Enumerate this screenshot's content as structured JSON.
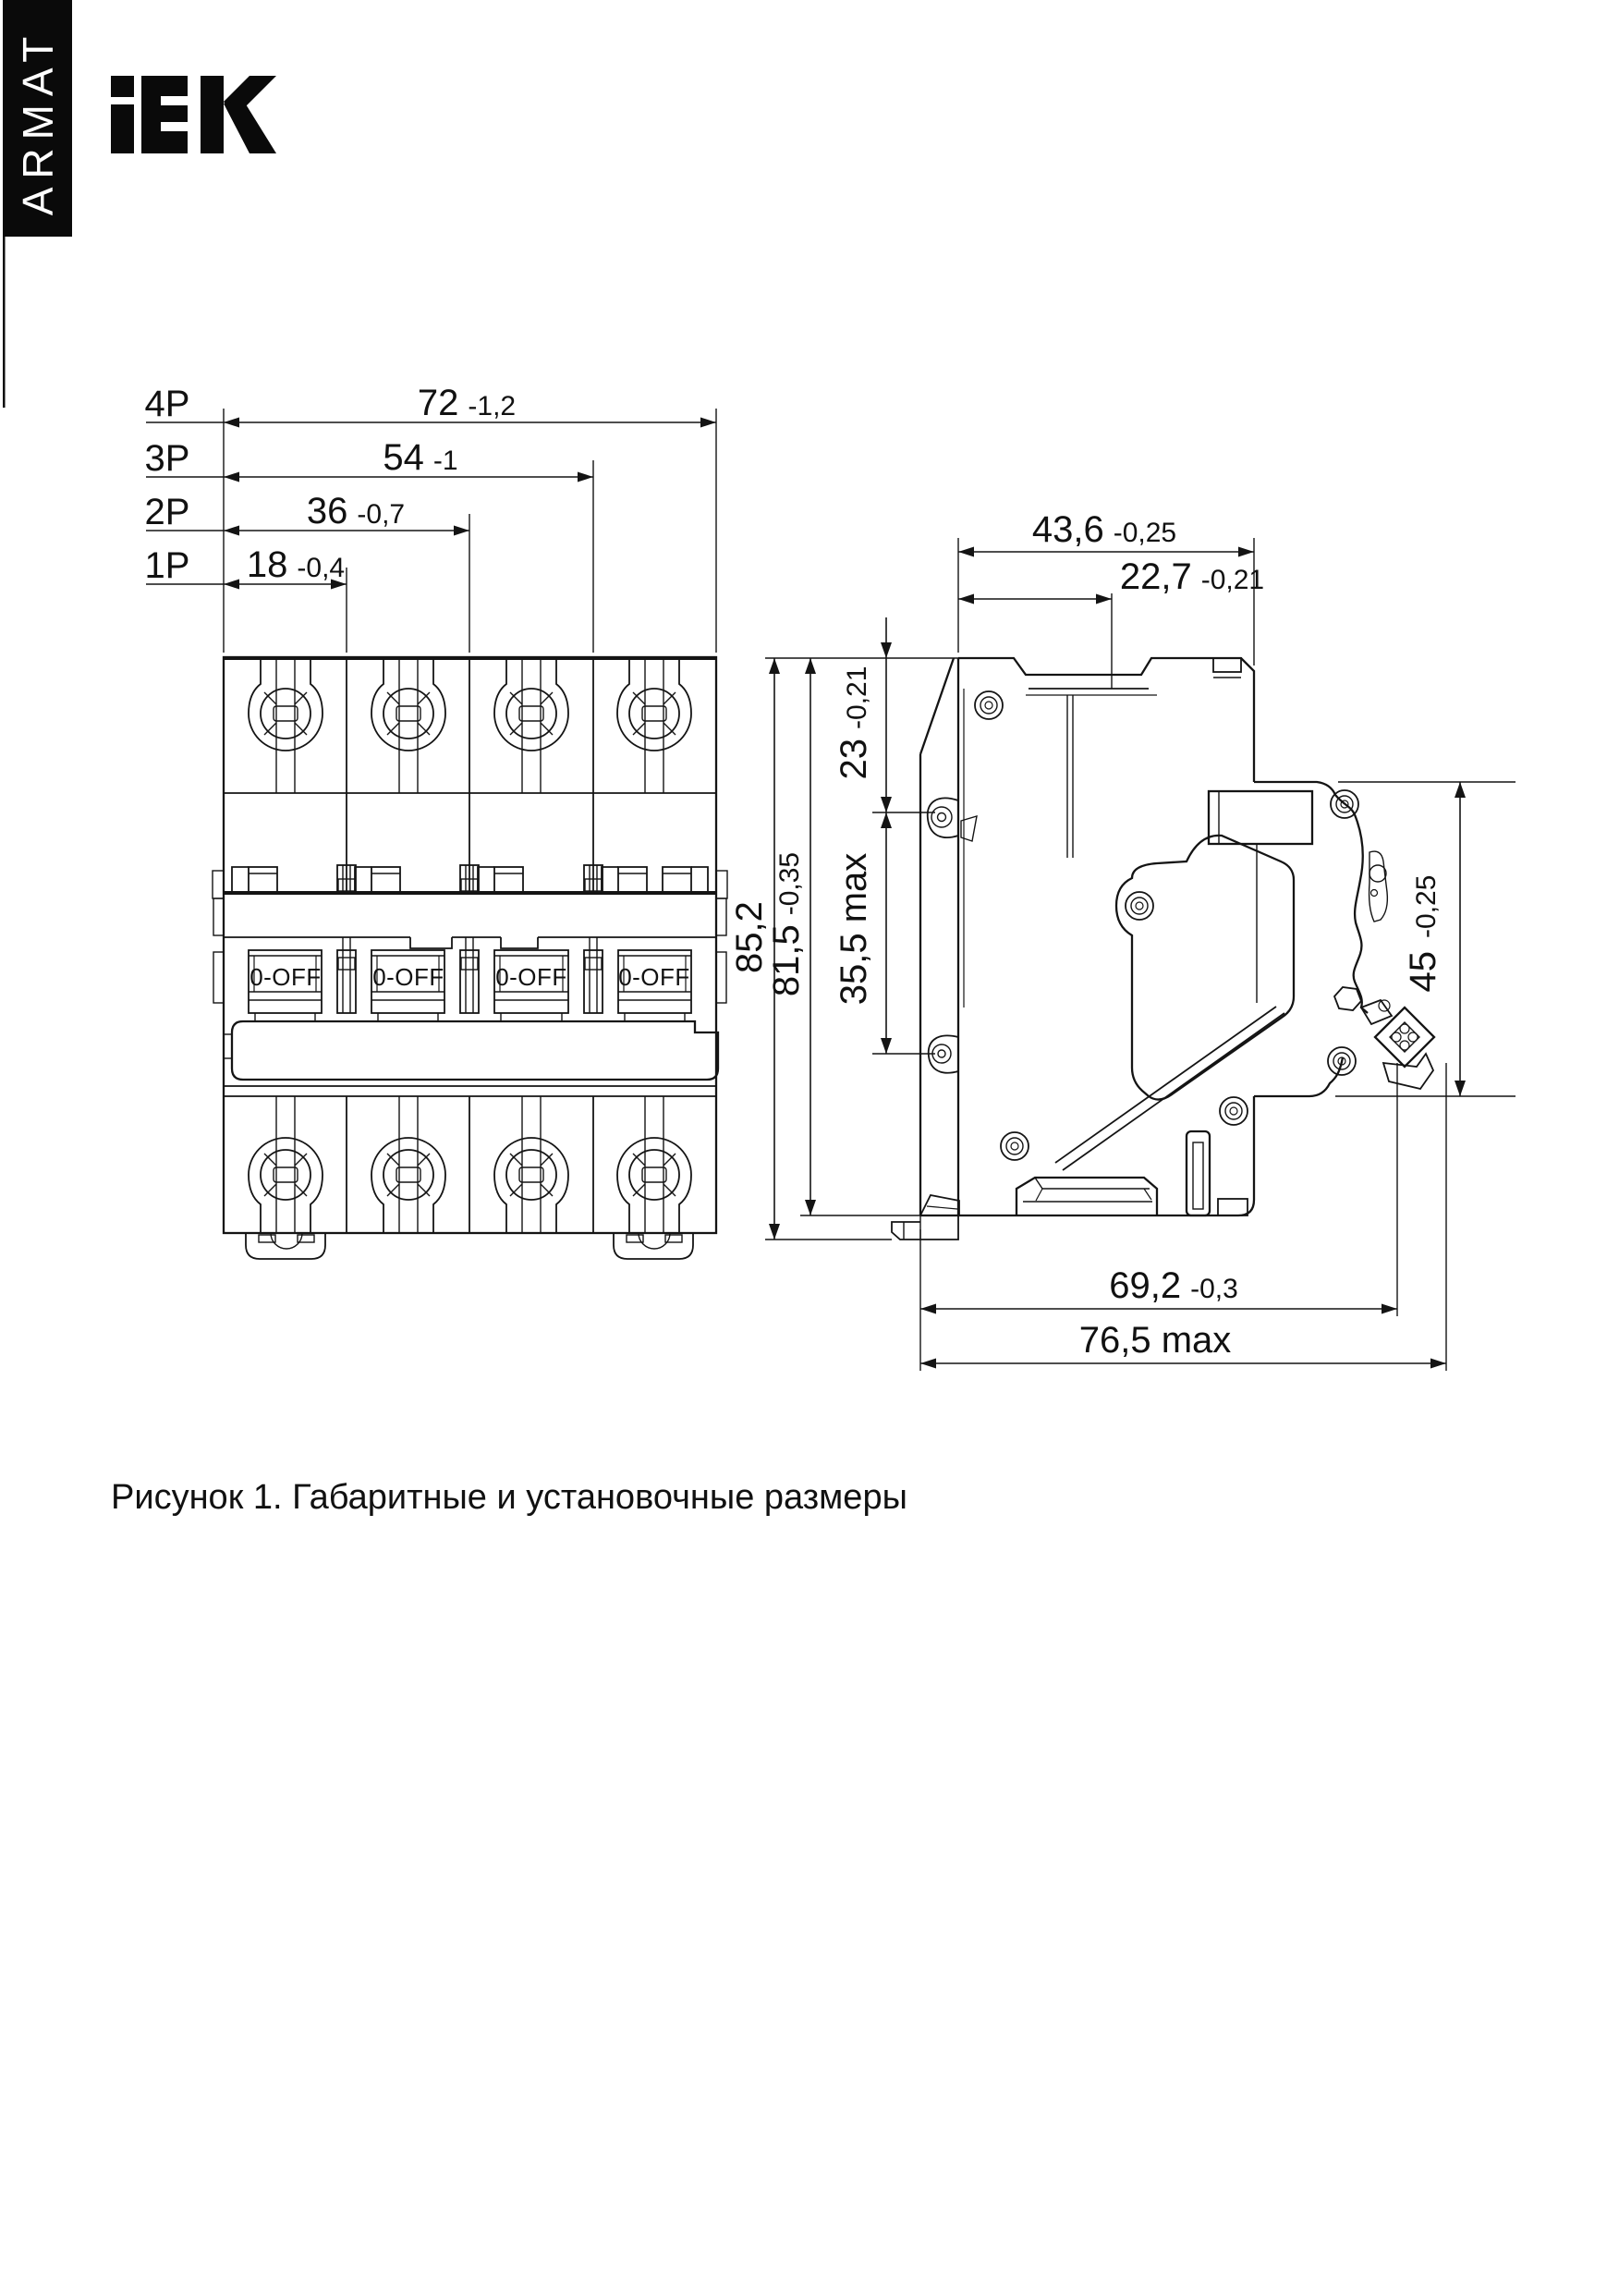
{
  "brand": {
    "vertical_label": "ARMAT",
    "logo": "iEK"
  },
  "front_view": {
    "handle_label": "0-OFF",
    "pole_dims": [
      {
        "pole": "4P",
        "value": "72",
        "tol": "-1,2"
      },
      {
        "pole": "3P",
        "value": "54",
        "tol": "-1"
      },
      {
        "pole": "2P",
        "value": "36",
        "tol": "-0,7"
      },
      {
        "pole": "1P",
        "value": "18",
        "tol": "-0,4"
      }
    ]
  },
  "side_view": {
    "dims": {
      "width": {
        "value": "43,6",
        "tol": "-0,25"
      },
      "terminal_offset": {
        "value": "22,7",
        "tol": "-0,21"
      },
      "top_to_mount_hole": {
        "value": "23",
        "tol": "-0,21"
      },
      "mount_hole_span": {
        "value": "35,5 max"
      },
      "height_overall": {
        "value": "85,2"
      },
      "height_body": {
        "value": "81,5",
        "tol": "-0,35"
      },
      "din_recess": {
        "value": "45",
        "tol": "-0,25"
      },
      "depth": {
        "value": "69,2",
        "tol": "-0,3"
      },
      "depth_max": {
        "value": "76,5 max"
      }
    }
  },
  "caption": "Рисунок 1. Габаритные и установочные размеры"
}
